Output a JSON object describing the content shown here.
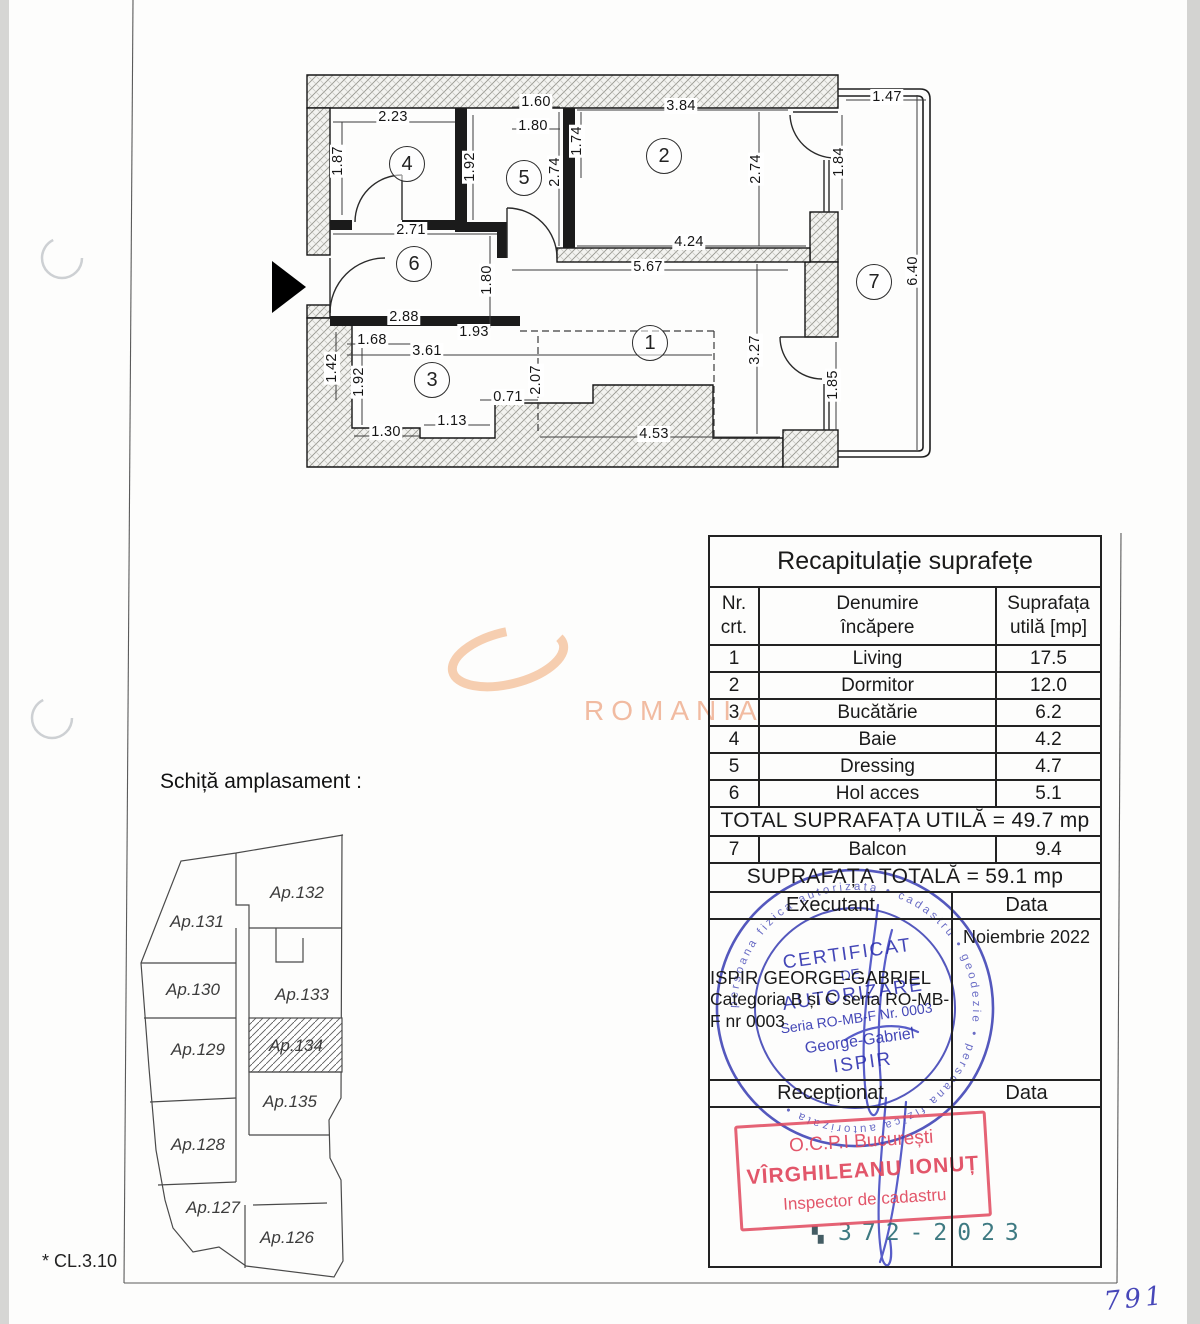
{
  "page": {
    "footnote": "* CL.3.10",
    "page_number": "791",
    "site_title": "Schiță amplasament :"
  },
  "watermark": {
    "text": "ROMANIA",
    "color": "#efab8b"
  },
  "floor_plan": {
    "rooms": [
      {
        "n": "1",
        "x": 650,
        "y": 343
      },
      {
        "n": "2",
        "x": 664,
        "y": 156
      },
      {
        "n": "3",
        "x": 432,
        "y": 380
      },
      {
        "n": "4",
        "x": 407,
        "y": 164
      },
      {
        "n": "5",
        "x": 524,
        "y": 178
      },
      {
        "n": "6",
        "x": 414,
        "y": 264
      },
      {
        "n": "7",
        "x": 874,
        "y": 282
      }
    ],
    "dims": [
      {
        "t": "2.23",
        "x": 393,
        "y": 117,
        "r": 0
      },
      {
        "t": "1.60",
        "x": 536,
        "y": 102,
        "r": 0
      },
      {
        "t": "1.80",
        "x": 533,
        "y": 126,
        "r": 0
      },
      {
        "t": "3.84",
        "x": 681,
        "y": 106,
        "r": 0
      },
      {
        "t": "1.47",
        "x": 887,
        "y": 97,
        "r": 0
      },
      {
        "t": "2.71",
        "x": 411,
        "y": 230,
        "r": 0
      },
      {
        "t": "4.24",
        "x": 689,
        "y": 242,
        "r": 0
      },
      {
        "t": "5.67",
        "x": 648,
        "y": 267,
        "r": 0
      },
      {
        "t": "2.88",
        "x": 404,
        "y": 317,
        "r": 0
      },
      {
        "t": "1.93",
        "x": 474,
        "y": 332,
        "r": 0
      },
      {
        "t": "1.68",
        "x": 372,
        "y": 340,
        "r": 0
      },
      {
        "t": "3.61",
        "x": 427,
        "y": 351,
        "r": 0
      },
      {
        "t": "1.30",
        "x": 386,
        "y": 432,
        "r": 0
      },
      {
        "t": "1.13",
        "x": 452,
        "y": 421,
        "r": 0
      },
      {
        "t": "0.71",
        "x": 508,
        "y": 397,
        "r": 0
      },
      {
        "t": "4.53",
        "x": 654,
        "y": 434,
        "r": 0
      },
      {
        "t": "1.87",
        "x": 338,
        "y": 161,
        "r": 1
      },
      {
        "t": "1.92",
        "x": 470,
        "y": 167,
        "r": 1
      },
      {
        "t": "2.74",
        "x": 555,
        "y": 172,
        "r": 1
      },
      {
        "t": "1.74",
        "x": 577,
        "y": 141,
        "r": 1
      },
      {
        "t": "2.74",
        "x": 756,
        "y": 169,
        "r": 1
      },
      {
        "t": "1.84",
        "x": 839,
        "y": 162,
        "r": 1
      },
      {
        "t": "6.40",
        "x": 913,
        "y": 271,
        "r": 1
      },
      {
        "t": "1.80",
        "x": 487,
        "y": 280,
        "r": 1
      },
      {
        "t": "1.42",
        "x": 332,
        "y": 368,
        "r": 1
      },
      {
        "t": "1.92",
        "x": 359,
        "y": 382,
        "r": 1
      },
      {
        "t": "2.07",
        "x": 536,
        "y": 380,
        "r": 1
      },
      {
        "t": "3.27",
        "x": 755,
        "y": 350,
        "r": 1
      },
      {
        "t": "1.85",
        "x": 833,
        "y": 385,
        "r": 1
      }
    ]
  },
  "site_sketch": {
    "highlighted_unit": "Ap.134",
    "units": [
      {
        "label": "Ap.132",
        "x": 297,
        "y": 893
      },
      {
        "label": "Ap.131",
        "x": 197,
        "y": 922
      },
      {
        "label": "Ap.130",
        "x": 193,
        "y": 990
      },
      {
        "label": "Ap.133",
        "x": 302,
        "y": 995
      },
      {
        "label": "Ap.129",
        "x": 198,
        "y": 1050
      },
      {
        "label": "Ap.134",
        "x": 296,
        "y": 1046
      },
      {
        "label": "Ap.135",
        "x": 290,
        "y": 1102
      },
      {
        "label": "Ap.128",
        "x": 198,
        "y": 1145
      },
      {
        "label": "Ap.127",
        "x": 213,
        "y": 1208
      },
      {
        "label": "Ap.126",
        "x": 287,
        "y": 1238
      }
    ]
  },
  "table": {
    "title": "Recapitulație suprafețe",
    "columns": [
      [
        "Nr.",
        "crt."
      ],
      [
        "Denumire",
        "încăpere"
      ],
      [
        "Suprafața",
        "utilă [mp]"
      ]
    ],
    "rows": [
      [
        "1",
        "Living",
        "17.5"
      ],
      [
        "2",
        "Dormitor",
        "12.0"
      ],
      [
        "3",
        "Bucătărie",
        "6.2"
      ],
      [
        "4",
        "Baie",
        "4.2"
      ],
      [
        "5",
        "Dressing",
        "4.7"
      ],
      [
        "6",
        "Hol acces",
        "5.1"
      ]
    ],
    "total_util": "TOTAL SUPRAFAȚA UTILĂ = 49.7 mp",
    "balcony_row": [
      "7",
      "Balcon",
      "9.4"
    ],
    "total_all": "SUPRAFAȚA TOTALĂ = 59.1 mp",
    "executant_label": "Executant",
    "data_label": "Data",
    "executant_name": "ISPIR GEORGE-GABRIEL",
    "executant_detail_lines": [
      "Categoria B și C seria RO-MB-",
      "F nr 0003"
    ],
    "date_value": "Noiembrie 2022",
    "receptionat_label": "Recepționat",
    "data_label2": "Data"
  },
  "stamps": {
    "round": {
      "color": "#2b2fae",
      "line1": "CERTIFICAT",
      "line2": "DE",
      "line3": "AUTORIZARE",
      "line4": "Seria RO-MB-F Nr. 0003",
      "line5": "George-Gabriel",
      "line6": "ISPIR",
      "ring_text": "persoana fizica autorizata • cadastru • geodezie • persoana fizica autorizata •"
    },
    "red": {
      "color": "#e0485d",
      "line1": "O.C.P.I București",
      "line2": "VÎRGHILEANU IONUȚ",
      "line3": "Inspector de cadastru"
    },
    "registry_number": "372-2023"
  }
}
